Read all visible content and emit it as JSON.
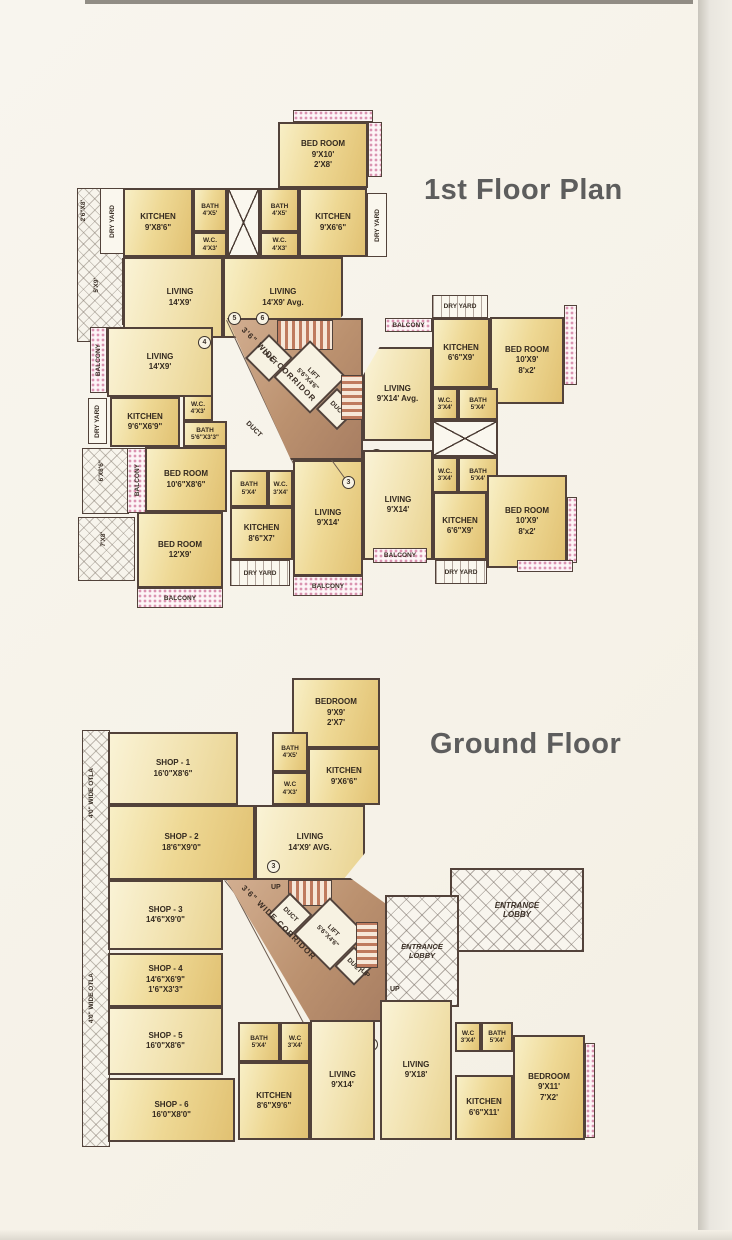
{
  "page": {
    "bg": "#f7f3ea"
  },
  "colors": {
    "room_fill": "#eed894",
    "corridor_fill": "#bb916f",
    "wall": "#52423a",
    "balcony_dot": "#d98fae",
    "stair_stripe": "#bf7a5e",
    "title_text": "#5d5d5d"
  },
  "floor1": {
    "title": "1st Floor Plan",
    "rooms": {
      "bed910": {
        "n": "BED ROOM",
        "a": "9'X10'",
        "b": "2'X8'"
      },
      "kit986": {
        "n": "KITCHEN",
        "a": "9'X8'6\""
      },
      "bath45": {
        "n": "BATH",
        "a": "4'X5'"
      },
      "wc43": {
        "n": "W.C.",
        "a": "4'X3'"
      },
      "kit966": {
        "n": "KITCHEN",
        "a": "9'X6'6\""
      },
      "liv149": {
        "n": "LIVING",
        "a": "14'X9'"
      },
      "liv149avg": {
        "n": "LIVING",
        "a": "14'X9' Avg."
      },
      "kit9669": {
        "n": "KITCHEN",
        "a": "9'6\"X6'9\""
      },
      "bath5633": {
        "n": "BATH",
        "a": "5'6\"X3'3\""
      },
      "bed10686": {
        "n": "BED ROOM",
        "a": "10'6\"X8'6\""
      },
      "bed129": {
        "n": "BED ROOM",
        "a": "12'X9'"
      },
      "bath54": {
        "n": "BATH",
        "a": "5'X4'"
      },
      "wc34": {
        "n": "W.C.",
        "a": "3'X4'"
      },
      "kit867": {
        "n": "KITCHEN",
        "a": "8'6\"X7'"
      },
      "liv914": {
        "n": "LIVING",
        "a": "9'X14'"
      },
      "liv914avg": {
        "n": "LIVING",
        "a": "9'X14' Avg."
      },
      "kit669": {
        "n": "KITCHEN",
        "a": "6'6\"X9'"
      },
      "bed109": {
        "n": "BED ROOM",
        "a": "10'X9'",
        "b": "8'x2'"
      }
    },
    "core": {
      "corridor": "3'6\" WIDE CORRIDOR",
      "lift": "LIFT",
      "lift_dims": "5'6\"X4'6\"",
      "duct": "DUCT"
    },
    "strips": {
      "balcony": "BALCONY",
      "dry_yard": "DRY YARD"
    },
    "dims": {
      "d268": "2'6\"X8'",
      "d59": "5'X9'",
      "d686": "6'X8'6\"",
      "d78": "7'X8'"
    },
    "markers": {
      "m1": "1",
      "m2": "2",
      "m3": "3",
      "m4": "4",
      "m5": "5",
      "m6": "6"
    }
  },
  "ground": {
    "title": "Ground Floor",
    "rooms": {
      "bed99": {
        "n": "BEDROOM",
        "a": "9'X9'",
        "b": "2'X7'"
      },
      "bath45": {
        "n": "BATH",
        "a": "4'X5'"
      },
      "wc43": {
        "n": "W.C",
        "a": "4'X3'"
      },
      "kit966": {
        "n": "KITCHEN",
        "a": "9'X6'6\""
      },
      "shop1": {
        "n": "SHOP - 1",
        "a": "16'0\"X8'6\""
      },
      "shop2": {
        "n": "SHOP - 2",
        "a": "18'6\"X9'0\""
      },
      "liv149avg": {
        "n": "LIVING",
        "a": "14'X9' AVG."
      },
      "shop3": {
        "n": "SHOP - 3",
        "a": "14'6\"X9'0\""
      },
      "shop4": {
        "n": "SHOP - 4",
        "a": "14'6\"X6'9\"",
        "b": "1'6\"X3'3\""
      },
      "shop5": {
        "n": "SHOP - 5",
        "a": "16'0\"X8'6\""
      },
      "shop6": {
        "n": "SHOP - 6",
        "a": "16'0\"X8'0\""
      },
      "bath54": {
        "n": "BATH",
        "a": "5'X4'"
      },
      "wc34": {
        "n": "W.C",
        "a": "3'X4'"
      },
      "liv914": {
        "n": "LIVING",
        "a": "9'X14'"
      },
      "kit8696": {
        "n": "KITCHEN",
        "a": "8'6\"X9'6\""
      },
      "liv918": {
        "n": "LIVING",
        "a": "9'X18'"
      },
      "bed911": {
        "n": "BEDROOM",
        "a": "9'X11'",
        "b": "7'X2'"
      },
      "kit6611": {
        "n": "KITCHEN",
        "a": "6'6\"X11'"
      }
    },
    "core": {
      "corridor": "3'6\" WIDE CORRIDOR",
      "lift": "LIFT",
      "lift_dims": "5'6\"X4'6\"",
      "duct": "DUCT",
      "up": "UP"
    },
    "lobby": {
      "n": "ENTRANCE",
      "a": "LOBBY"
    },
    "otla": "4'0\" WIDE OTLA",
    "markers": {
      "m1": "1",
      "m2": "2",
      "m3": "3"
    }
  }
}
